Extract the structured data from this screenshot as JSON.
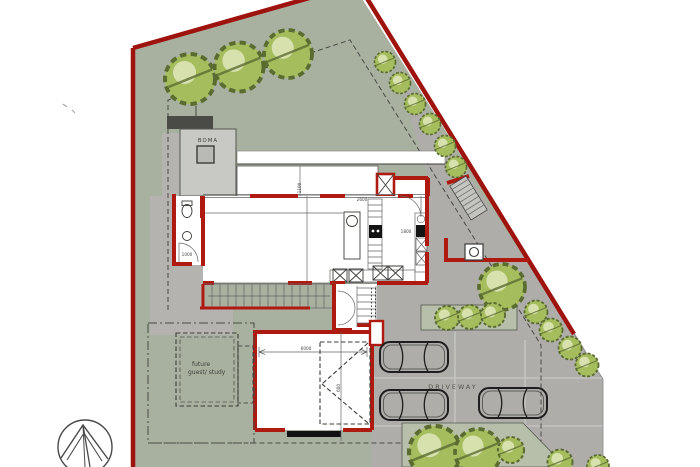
{
  "labels": {
    "boma": "BOMA",
    "future_guest_line1": "future",
    "future_guest_line2": "guest/ study",
    "driveway": "DRIVEWAY"
  },
  "dims": [
    {
      "text": "1100"
    },
    {
      "text": "2600"
    },
    {
      "text": "1800"
    },
    {
      "text": "1000"
    },
    {
      "text": "6000"
    },
    {
      "text": "600"
    }
  ],
  "icons": {
    "north_arrow": "north-arrow",
    "tree": "tree",
    "car": "car"
  },
  "colors": {
    "boundary-red": "#9e130e",
    "wall-red": "#ae1a10",
    "lawn-green": "#a8b1a0",
    "paving-gray": "#b4b3af",
    "driveway-gray": "#aeada9",
    "structure-gray": "#c8c8c4",
    "tree-fill": "#a6bd5e",
    "tree-edge": "#5b6c31",
    "line-dark": "#3c3c38",
    "dim-text": "#444444"
  }
}
